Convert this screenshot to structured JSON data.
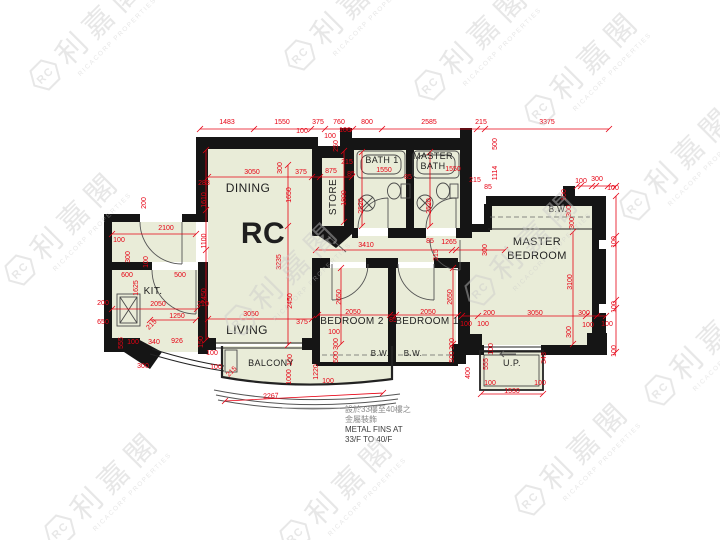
{
  "colors": {
    "wall": "#151515",
    "floor": "#e9ecd8",
    "dim": "#e60012",
    "label": "#1f1f1f",
    "fixture": "#4a4a4a",
    "watermark": "#c9c9c9"
  },
  "watermark": {
    "chars": "利嘉閣",
    "company": "RICACORP PROPERTIES",
    "monogram": "RC",
    "positions": [
      [
        45,
        75
      ],
      [
        300,
        55
      ],
      [
        540,
        110
      ],
      [
        20,
        270
      ],
      [
        240,
        320
      ],
      [
        480,
        290
      ],
      [
        635,
        205
      ],
      [
        60,
        530
      ],
      [
        295,
        535
      ],
      [
        530,
        500
      ],
      [
        660,
        390
      ],
      [
        430,
        85
      ]
    ]
  },
  "rooms": [
    {
      "t": "DINING",
      "x": 248,
      "y": 192,
      "s": 12
    },
    {
      "t": "RC",
      "x": 263,
      "y": 243,
      "s": 30,
      "w": 600
    },
    {
      "t": "LIVING",
      "x": 247,
      "y": 334,
      "s": 12
    },
    {
      "t": "KIT.",
      "x": 153,
      "y": 294,
      "s": 10
    },
    {
      "t": "STORE",
      "x": 336,
      "y": 197,
      "s": 10,
      "r": -90
    },
    {
      "t": "BATH 1",
      "x": 382,
      "y": 163,
      "s": 9
    },
    {
      "lines": [
        "MASTER",
        "BATH"
      ],
      "x": 433,
      "y": 159,
      "s": 9,
      "lh": 10
    },
    {
      "t": "BEDROOM 2",
      "x": 352,
      "y": 324,
      "s": 10
    },
    {
      "t": "BEDROOM 1",
      "x": 427,
      "y": 324,
      "s": 10
    },
    {
      "lines": [
        "MASTER",
        "BEDROOM"
      ],
      "x": 537,
      "y": 245,
      "s": 11,
      "lh": 14
    },
    {
      "t": "BALCONY",
      "x": 271,
      "y": 366,
      "s": 9
    },
    {
      "t": "U.P.",
      "x": 512,
      "y": 366,
      "s": 9
    },
    {
      "t": "B.W.",
      "x": 380,
      "y": 356,
      "s": 8
    },
    {
      "t": "B.W.",
      "x": 413,
      "y": 356,
      "s": 8
    },
    {
      "t": "B.W.",
      "x": 558,
      "y": 212,
      "s": 8
    }
  ],
  "dims": [
    [
      "1483",
      227,
      124,
      0
    ],
    [
      "1550",
      282,
      124,
      0
    ],
    [
      "375",
      318,
      124,
      0
    ],
    [
      "760",
      339,
      124,
      0
    ],
    [
      "800",
      367,
      124,
      0
    ],
    [
      "2585",
      429,
      124,
      0
    ],
    [
      "215",
      481,
      124,
      0
    ],
    [
      "3375",
      547,
      124,
      0
    ],
    [
      "100",
      302,
      133,
      0
    ],
    [
      "100",
      330,
      138,
      0
    ],
    [
      "100",
      345,
      132,
      0
    ],
    [
      "250",
      338,
      146,
      -90
    ],
    [
      "500",
      497,
      144,
      -90
    ],
    [
      "3050",
      252,
      174,
      0
    ],
    [
      "375",
      301,
      174,
      0
    ],
    [
      "875",
      331,
      173,
      0
    ],
    [
      "283",
      204,
      185,
      0
    ],
    [
      "300",
      282,
      168,
      -90
    ],
    [
      "215",
      347,
      164,
      0
    ],
    [
      "85",
      351,
      176,
      0
    ],
    [
      "1550",
      384,
      172,
      0
    ],
    [
      "85",
      408,
      179,
      0
    ],
    [
      "1550",
      453,
      171,
      0
    ],
    [
      "215",
      475,
      182,
      0
    ],
    [
      "85",
      488,
      189,
      0
    ],
    [
      "2520",
      363,
      206,
      -90
    ],
    [
      "2520",
      431,
      206,
      -90
    ],
    [
      "1800",
      346,
      198,
      -90
    ],
    [
      "1610",
      206,
      200,
      -90
    ],
    [
      "1650",
      291,
      195,
      -90
    ],
    [
      "3235",
      281,
      262,
      -90
    ],
    [
      "1114",
      497,
      173,
      -90
    ],
    [
      "100",
      581,
      183,
      0
    ],
    [
      "300",
      597,
      181,
      0
    ],
    [
      "100",
      613,
      190,
      0
    ],
    [
      "100",
      566,
      195,
      -90
    ],
    [
      "300",
      571,
      211,
      -90
    ],
    [
      "300",
      574,
      223,
      -90
    ],
    [
      "200",
      146,
      203,
      -90
    ],
    [
      "2100",
      166,
      230,
      0
    ],
    [
      "100",
      119,
      242,
      0
    ],
    [
      "300",
      130,
      257,
      -90
    ],
    [
      "100",
      148,
      262,
      -90
    ],
    [
      "1100",
      206,
      241,
      -90
    ],
    [
      "2450",
      206,
      296,
      -90
    ],
    [
      "600",
      127,
      277,
      0
    ],
    [
      "500",
      180,
      277,
      0
    ],
    [
      "1625",
      138,
      288,
      -90
    ],
    [
      "200",
      103,
      305,
      0
    ],
    [
      "2050",
      158,
      306,
      0
    ],
    [
      "1250",
      177,
      318,
      0
    ],
    [
      "210",
      203,
      306,
      0
    ],
    [
      "650",
      103,
      324,
      0
    ],
    [
      "555",
      123,
      343,
      -90
    ],
    [
      "100",
      133,
      344,
      0
    ],
    [
      "340",
      154,
      344,
      0
    ],
    [
      "215",
      153,
      326,
      -45
    ],
    [
      "926",
      177,
      343,
      0
    ],
    [
      "300",
      143,
      368,
      0
    ],
    [
      "3050",
      251,
      316,
      0
    ],
    [
      "375",
      302,
      324,
      0
    ],
    [
      "2450",
      292,
      301,
      -90
    ],
    [
      "150",
      203,
      342,
      -90
    ],
    [
      "100",
      212,
      355,
      0
    ],
    [
      "100",
      216,
      369,
      0
    ],
    [
      "215",
      233,
      373,
      -45
    ],
    [
      "100",
      292,
      360,
      -90
    ],
    [
      "1000",
      291,
      377,
      -90
    ],
    [
      "1220",
      318,
      372,
      -90
    ],
    [
      "100",
      328,
      383,
      0
    ],
    [
      "2267",
      271,
      398,
      -3
    ],
    [
      "3410",
      366,
      247,
      0
    ],
    [
      "85",
      430,
      243,
      0
    ],
    [
      "1265",
      449,
      244,
      0
    ],
    [
      "315",
      438,
      255,
      -90
    ],
    [
      "2650",
      341,
      297,
      -90
    ],
    [
      "2650",
      452,
      297,
      -90
    ],
    [
      "2050",
      353,
      314,
      0
    ],
    [
      "85",
      393,
      322,
      0
    ],
    [
      "2050",
      428,
      314,
      0
    ],
    [
      "100",
      334,
      334,
      0
    ],
    [
      "300",
      338,
      344,
      -90
    ],
    [
      "500",
      338,
      357,
      -90
    ],
    [
      "300",
      454,
      344,
      -90
    ],
    [
      "500",
      454,
      357,
      -90
    ],
    [
      "100",
      466,
      326,
      0
    ],
    [
      "100",
      483,
      326,
      0
    ],
    [
      "400",
      470,
      373,
      -90
    ],
    [
      "300",
      487,
      250,
      -90
    ],
    [
      "3100",
      572,
      282,
      -90
    ],
    [
      "200",
      489,
      315,
      0
    ],
    [
      "3050",
      535,
      315,
      0
    ],
    [
      "300",
      584,
      315,
      0
    ],
    [
      "100",
      588,
      327,
      0
    ],
    [
      "100",
      607,
      326,
      0
    ],
    [
      "300",
      571,
      332,
      -90
    ],
    [
      "100",
      616,
      242,
      -90
    ],
    [
      "100",
      616,
      307,
      -90
    ],
    [
      "100",
      616,
      351,
      -90
    ],
    [
      "1530",
      512,
      393,
      0
    ],
    [
      "100",
      490,
      385,
      0
    ],
    [
      "100",
      540,
      385,
      0
    ],
    [
      "555",
      488,
      364,
      -90
    ],
    [
      "100",
      493,
      349,
      -90
    ],
    [
      "343",
      546,
      358,
      -90
    ]
  ],
  "chains": [
    {
      "o": "h",
      "p": 129,
      "a": 200,
      "b": 609,
      "t": [
        200,
        254,
        311,
        325,
        353,
        382,
        477,
        485,
        609
      ]
    },
    {
      "o": "h",
      "p": 177,
      "a": 208,
      "b": 352,
      "t": [
        208,
        312,
        320,
        352
      ]
    },
    {
      "o": "h",
      "p": 234,
      "a": 112,
      "b": 196,
      "t": [
        112,
        196
      ]
    },
    {
      "o": "h",
      "p": 309,
      "a": 112,
      "b": 197,
      "t": [
        112,
        197
      ]
    },
    {
      "o": "h",
      "p": 320,
      "a": 150,
      "b": 196,
      "t": [
        150,
        196
      ]
    },
    {
      "o": "h",
      "p": 319,
      "a": 208,
      "b": 312,
      "t": [
        208,
        312
      ]
    },
    {
      "o": "h",
      "p": 315,
      "a": 318,
      "b": 458,
      "t": [
        318,
        390,
        396,
        458
      ]
    },
    {
      "o": "h",
      "p": 316,
      "a": 462,
      "b": 606,
      "t": [
        462,
        478,
        586,
        597,
        606
      ]
    },
    {
      "o": "h",
      "p": 250,
      "a": 316,
      "b": 505,
      "t": [
        316,
        452,
        456,
        505
      ]
    },
    {
      "o": "h",
      "p": 394,
      "a": 481,
      "b": 543,
      "t": [
        481,
        543
      ]
    },
    {
      "o": "h",
      "p": 186,
      "a": 577,
      "b": 616,
      "t": [
        577,
        581,
        592,
        596,
        608,
        616
      ]
    },
    {
      "o": "v",
      "p": 206,
      "a": 150,
      "b": 340,
      "t": [
        150,
        210,
        250,
        340
      ]
    },
    {
      "o": "v",
      "p": 288,
      "a": 165,
      "b": 345,
      "t": [
        165,
        226,
        345
      ]
    },
    {
      "o": "v",
      "p": 344,
      "a": 151,
      "b": 222,
      "t": [
        151,
        222
      ]
    },
    {
      "o": "v",
      "p": 362,
      "a": 152,
      "b": 226,
      "t": [
        152,
        226
      ]
    },
    {
      "o": "v",
      "p": 430,
      "a": 152,
      "b": 226,
      "t": [
        152,
        226
      ]
    },
    {
      "o": "v",
      "p": 341,
      "a": 268,
      "b": 344,
      "t": [
        268,
        344
      ]
    },
    {
      "o": "v",
      "p": 453,
      "a": 268,
      "b": 344,
      "t": [
        268,
        344
      ]
    },
    {
      "o": "v",
      "p": 573,
      "a": 232,
      "b": 344,
      "t": [
        232,
        344
      ]
    },
    {
      "o": "v",
      "p": 616,
      "a": 196,
      "b": 352,
      "t": [
        196,
        236,
        244,
        300,
        308,
        352
      ]
    }
  ],
  "annotation": {
    "x": 345,
    "y": 412,
    "lh": 10,
    "lines": [
      {
        "t": "設於33樓至40樓之",
        "c": "#8a8a8a"
      },
      {
        "t": "金屬裝飾",
        "c": "#8a8a8a"
      },
      {
        "t": "METAL FINS AT",
        "c": "#3c3c3c"
      },
      {
        "t": "33/F TO 40/F",
        "c": "#3c3c3c"
      }
    ]
  }
}
